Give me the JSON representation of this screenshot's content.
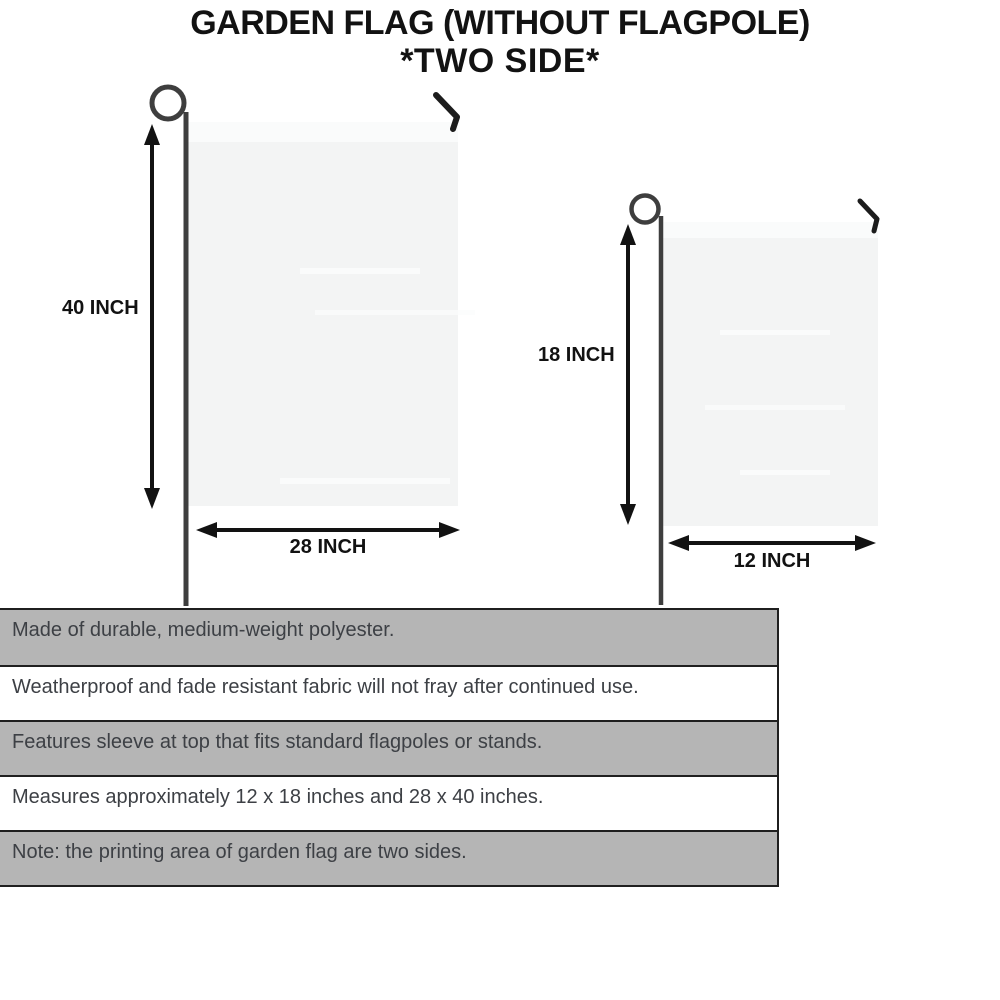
{
  "title": {
    "line1": "GARDEN FLAG (WITHOUT FLAGPOLE)",
    "line2": "*TWO SIDE*"
  },
  "flags": {
    "large": {
      "height_label": "40 INCH",
      "width_label": "28 INCH"
    },
    "small": {
      "height_label": "18 INCH",
      "width_label": "12 INCH"
    }
  },
  "features": {
    "items": [
      {
        "text": "Made of durable, medium-weight polyester.",
        "shade": "gray"
      },
      {
        "text": "Weatherproof and fade resistant fabric will not fray after continued use.",
        "shade": "white"
      },
      {
        "text": "Features sleeve at top that fits standard flagpoles or stands.",
        "shade": "gray"
      },
      {
        "text": "Measures approximately 12 x 18 inches and 28 x 40 inches.",
        "shade": "white"
      },
      {
        "text": "Note: the printing area of garden flag are two sides.",
        "shade": "gray"
      }
    ]
  },
  "colors": {
    "stripe_gray": "#b5b5b5",
    "stripe_white": "#ffffff",
    "flag_fill": "#f3f4f4",
    "flag_sleeve": "#fafbfb",
    "pole": "#3e3e3e",
    "ink": "#121212",
    "border_dark": "#1f1f1f",
    "feature_text": "#3d4045"
  }
}
